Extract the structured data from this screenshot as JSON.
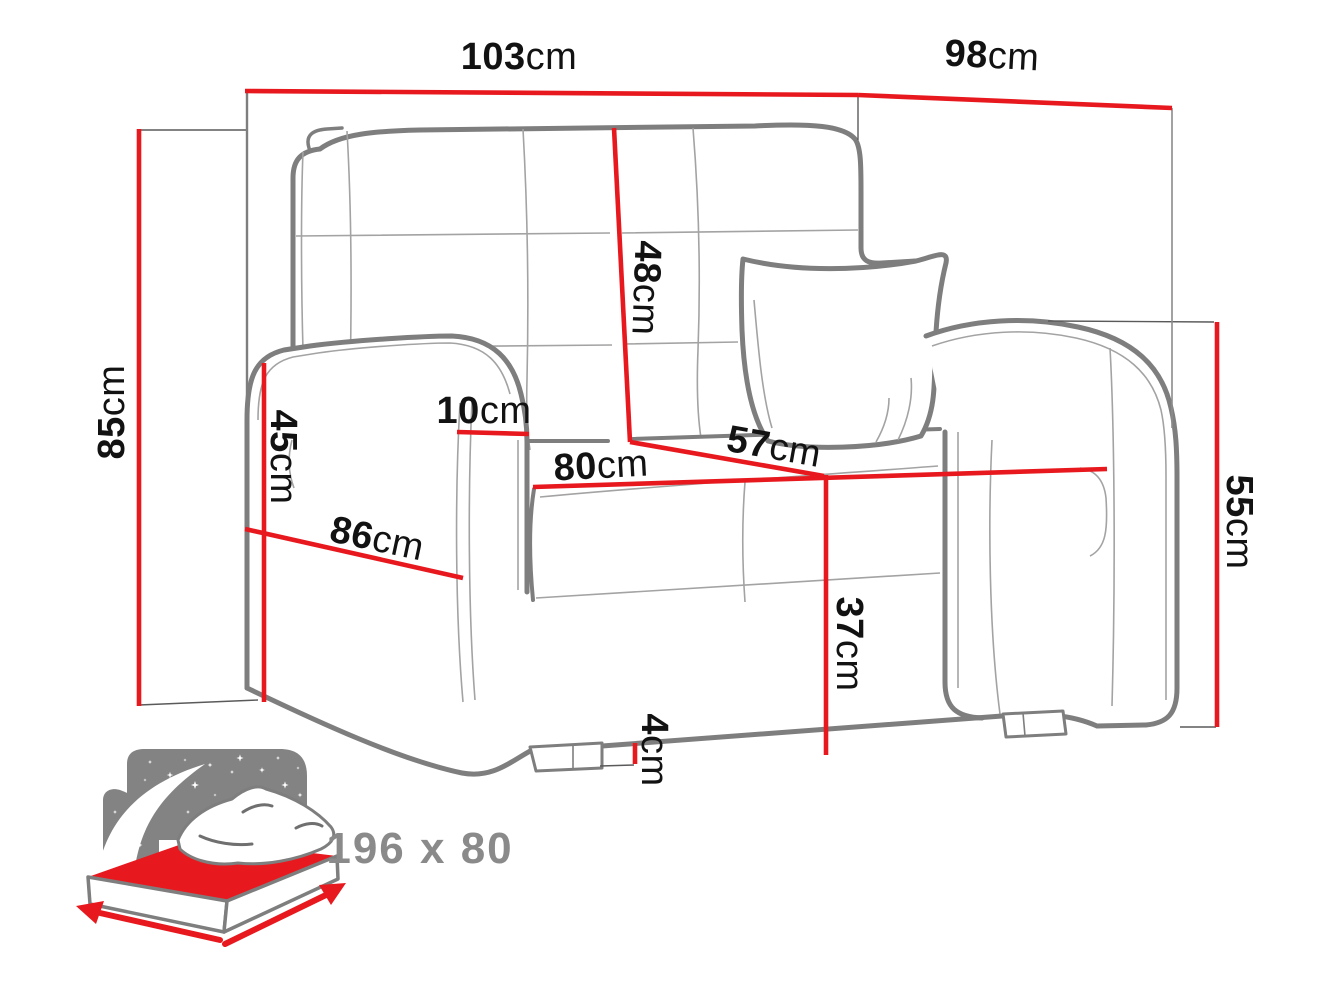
{
  "diagram": {
    "kind": "sofa-bed dimension drawing",
    "unit": "cm"
  },
  "colors": {
    "dimension_line_red": "#e8191e",
    "outline_gray": "#7e7e7e",
    "thin_line_gray": "#a0a0a0",
    "icon_gray": "#838383",
    "label_text": "#121212",
    "sleeping_label_gray": "#8a8a8a"
  },
  "dimensions": {
    "overall_width": {
      "value": "103",
      "unit": "cm"
    },
    "overall_depth": {
      "value": "98",
      "unit": "cm"
    },
    "overall_height": {
      "value": "85",
      "unit": "cm"
    },
    "armrest_height": {
      "value": "45",
      "unit": "cm"
    },
    "armrest_width": {
      "value": "10",
      "unit": "cm"
    },
    "backrest_height": {
      "value": "48",
      "unit": "cm"
    },
    "seat_depth": {
      "value": "57",
      "unit": "cm"
    },
    "seat_width": {
      "value": "80",
      "unit": "cm"
    },
    "side_depth": {
      "value": "86",
      "unit": "cm"
    },
    "seat_height": {
      "value": "37",
      "unit": "cm"
    },
    "leg_height": {
      "value": "4",
      "unit": "cm"
    },
    "armrest_outer_height": {
      "value": "55",
      "unit": "cm"
    }
  },
  "sleeping_area": {
    "label": "196 x 80"
  }
}
